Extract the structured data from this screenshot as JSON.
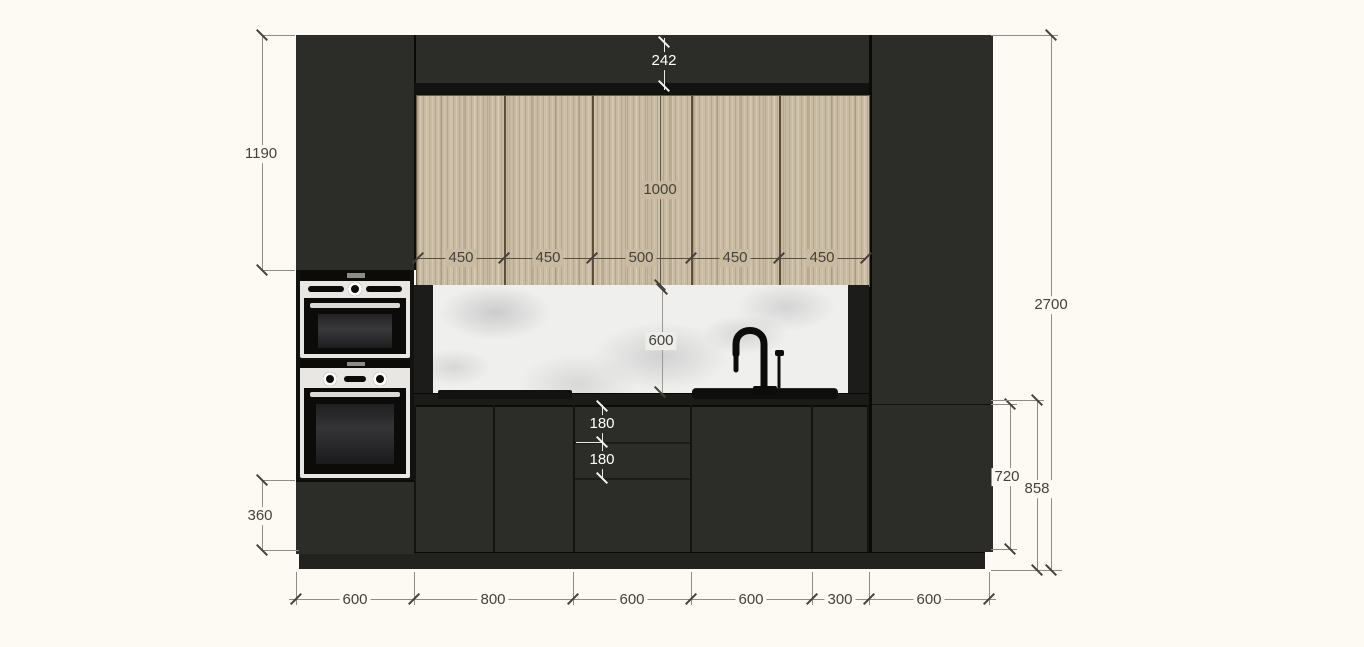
{
  "drawing": {
    "type": "kitchen-elevation",
    "colors": {
      "background": "#fcfaf2",
      "cabinet_dark": "#2c2c29",
      "cabinet_edge_black": "#121210",
      "wood_front": "#c9bba1",
      "marble_backsplash": "#efefed",
      "stainless": "#e9e7e3",
      "dim_text_dark": "#46423a",
      "dim_text_light": "#ffffff",
      "dim_line": "#8f8d86"
    },
    "dimensions": {
      "soffit_height": "242",
      "tall_unit_upper_door": "1190",
      "wall_cabinet_height": "1000",
      "wall_cabinet_widths": [
        "450",
        "450",
        "500",
        "450",
        "450"
      ],
      "backsplash_height": "600",
      "top_drawer_height": "180",
      "second_drawer_height": "180",
      "bottom_left_drawer_height": "360",
      "total_height": "2700",
      "base_unit_height": "720",
      "worktop_to_floor": "858",
      "base_unit_widths": [
        "600",
        "800",
        "600",
        "600",
        "300",
        "600"
      ]
    }
  }
}
